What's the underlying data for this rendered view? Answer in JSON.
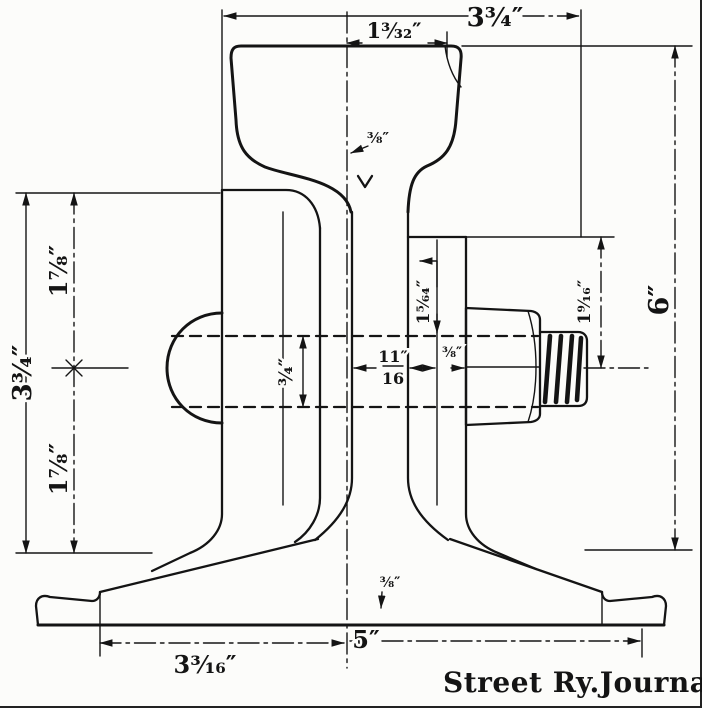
{
  "drawing": {
    "credit": "Street Ry.Journal",
    "dimensions": {
      "top_overall": "3¾″",
      "top_head": "1³⁄₃₂″",
      "right_height": "6″",
      "left_overall": "3¾″",
      "left_upper": "1⅞″",
      "left_lower": "1⅞″",
      "head_gap": "⅜″",
      "bolt_hole_dia": "¾″",
      "web_thickness_num": "11″",
      "web_thickness_den": "16",
      "bolt_upper_offset": "1⁵⁄₆₄″",
      "plate_gap": "⅜″",
      "bolt_center_offset": "1⁹⁄₁₆″",
      "base_web": "⅜″",
      "base_left": "3³⁄₁₆″",
      "base_center": "5″"
    }
  }
}
